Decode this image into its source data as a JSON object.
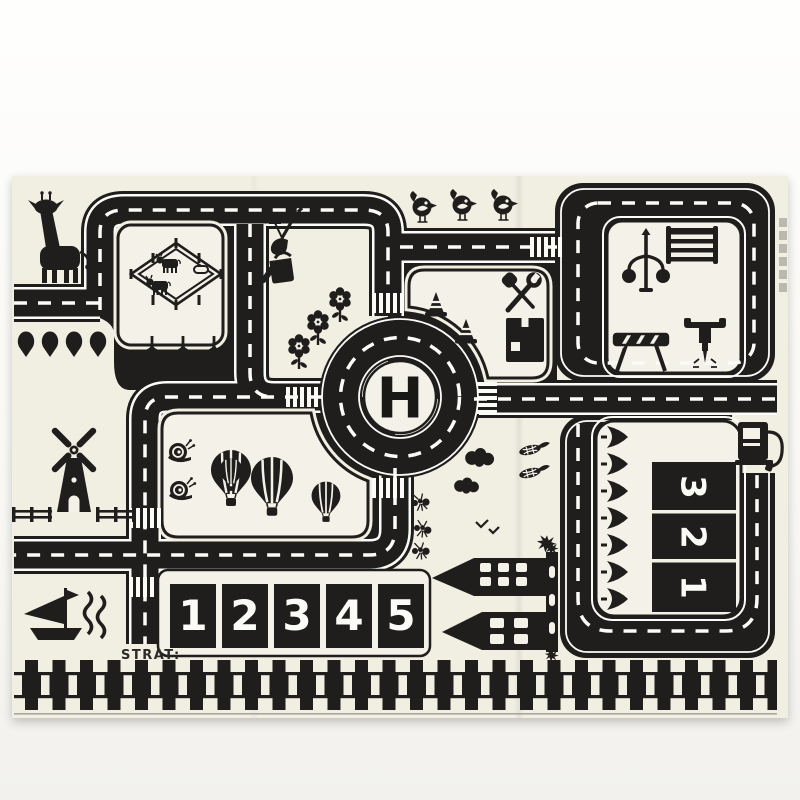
{
  "photo": {
    "description": "photograph of a black and white kids traffic road play mat",
    "background_top": "#fefefd",
    "background_bottom": "#f2f1ed",
    "mat_color": "#f1eee2",
    "road_color": "#1f1e1c",
    "marking_color": "#fbfbf8"
  },
  "mat": {
    "helipad_label": "H",
    "start_label": "STRAT:",
    "bottom_parking": {
      "spaces": [
        "1",
        "2",
        "3",
        "4",
        "5"
      ]
    },
    "side_parking": {
      "spaces": [
        "3",
        "2",
        "1"
      ]
    },
    "icons": [
      "giraffe",
      "cow-paddock",
      "cows",
      "spade-trees",
      "wind-turbines",
      "garden-shovel-fork",
      "watering-can",
      "flowers",
      "birds",
      "traffic-cones",
      "wrench-screwdriver",
      "toolbox",
      "street-lamp",
      "ladder-barrier",
      "striped-barrier",
      "jackhammer",
      "windmill",
      "fences",
      "snails",
      "hot-air-balloons",
      "ants",
      "bushes",
      "corn",
      "flying-birds",
      "castle",
      "sailboat",
      "waves",
      "pine-trees",
      "gas-pump",
      "helipad-roundabout",
      "crosswalks",
      "railroad-track"
    ]
  }
}
